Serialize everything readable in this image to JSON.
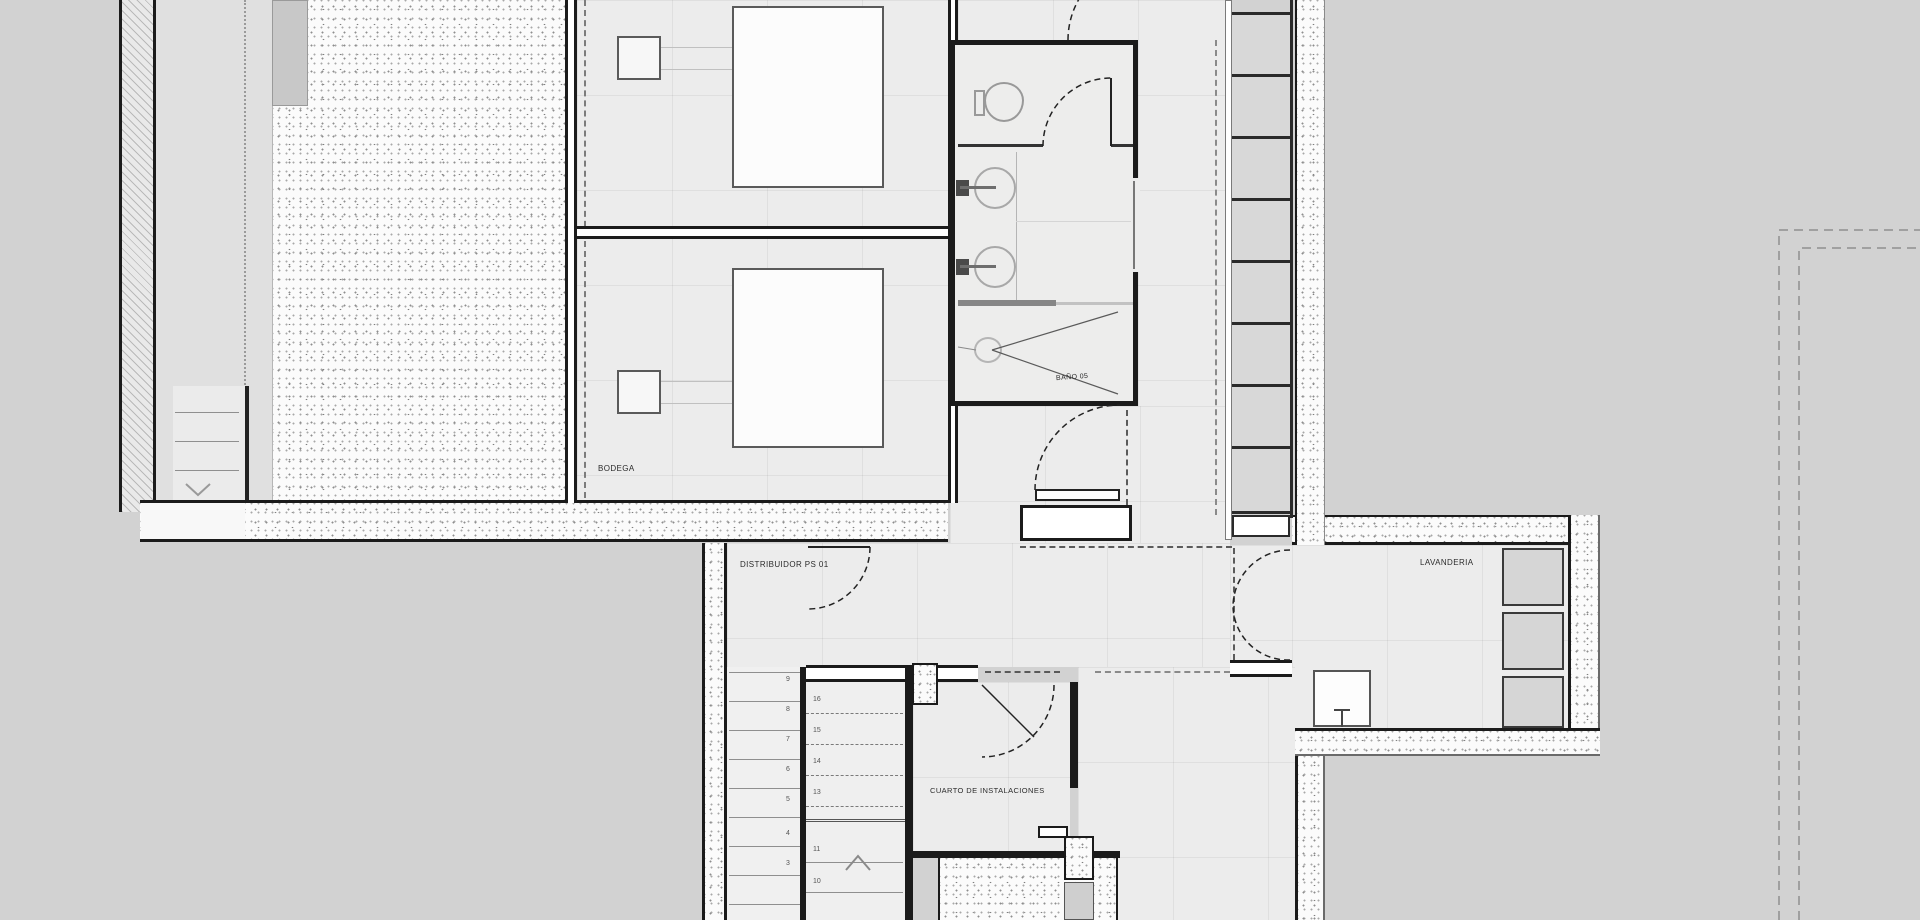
{
  "plan": {
    "rooms": {
      "bodega": "BODEGA",
      "distribuidor": "DISTRIBUIDOR PS 01",
      "lavanderia": "LAVANDERIA",
      "cuarto_instalaciones": "CUARTO DE INSTALACIONES",
      "bano": "BAÑO 05"
    },
    "stairs": {
      "upper": [
        "16",
        "15",
        "14",
        "13"
      ],
      "lower": [
        "11",
        "10"
      ],
      "left": [
        "9",
        "8",
        "7",
        "6",
        "5",
        "4",
        "3"
      ]
    },
    "colors": {
      "exterior": "#d2d2d2",
      "floor": "#ececec",
      "wall": "#1b1b1b",
      "furn": "#d6d6d6",
      "stipbg": "#fbfbfb"
    }
  }
}
